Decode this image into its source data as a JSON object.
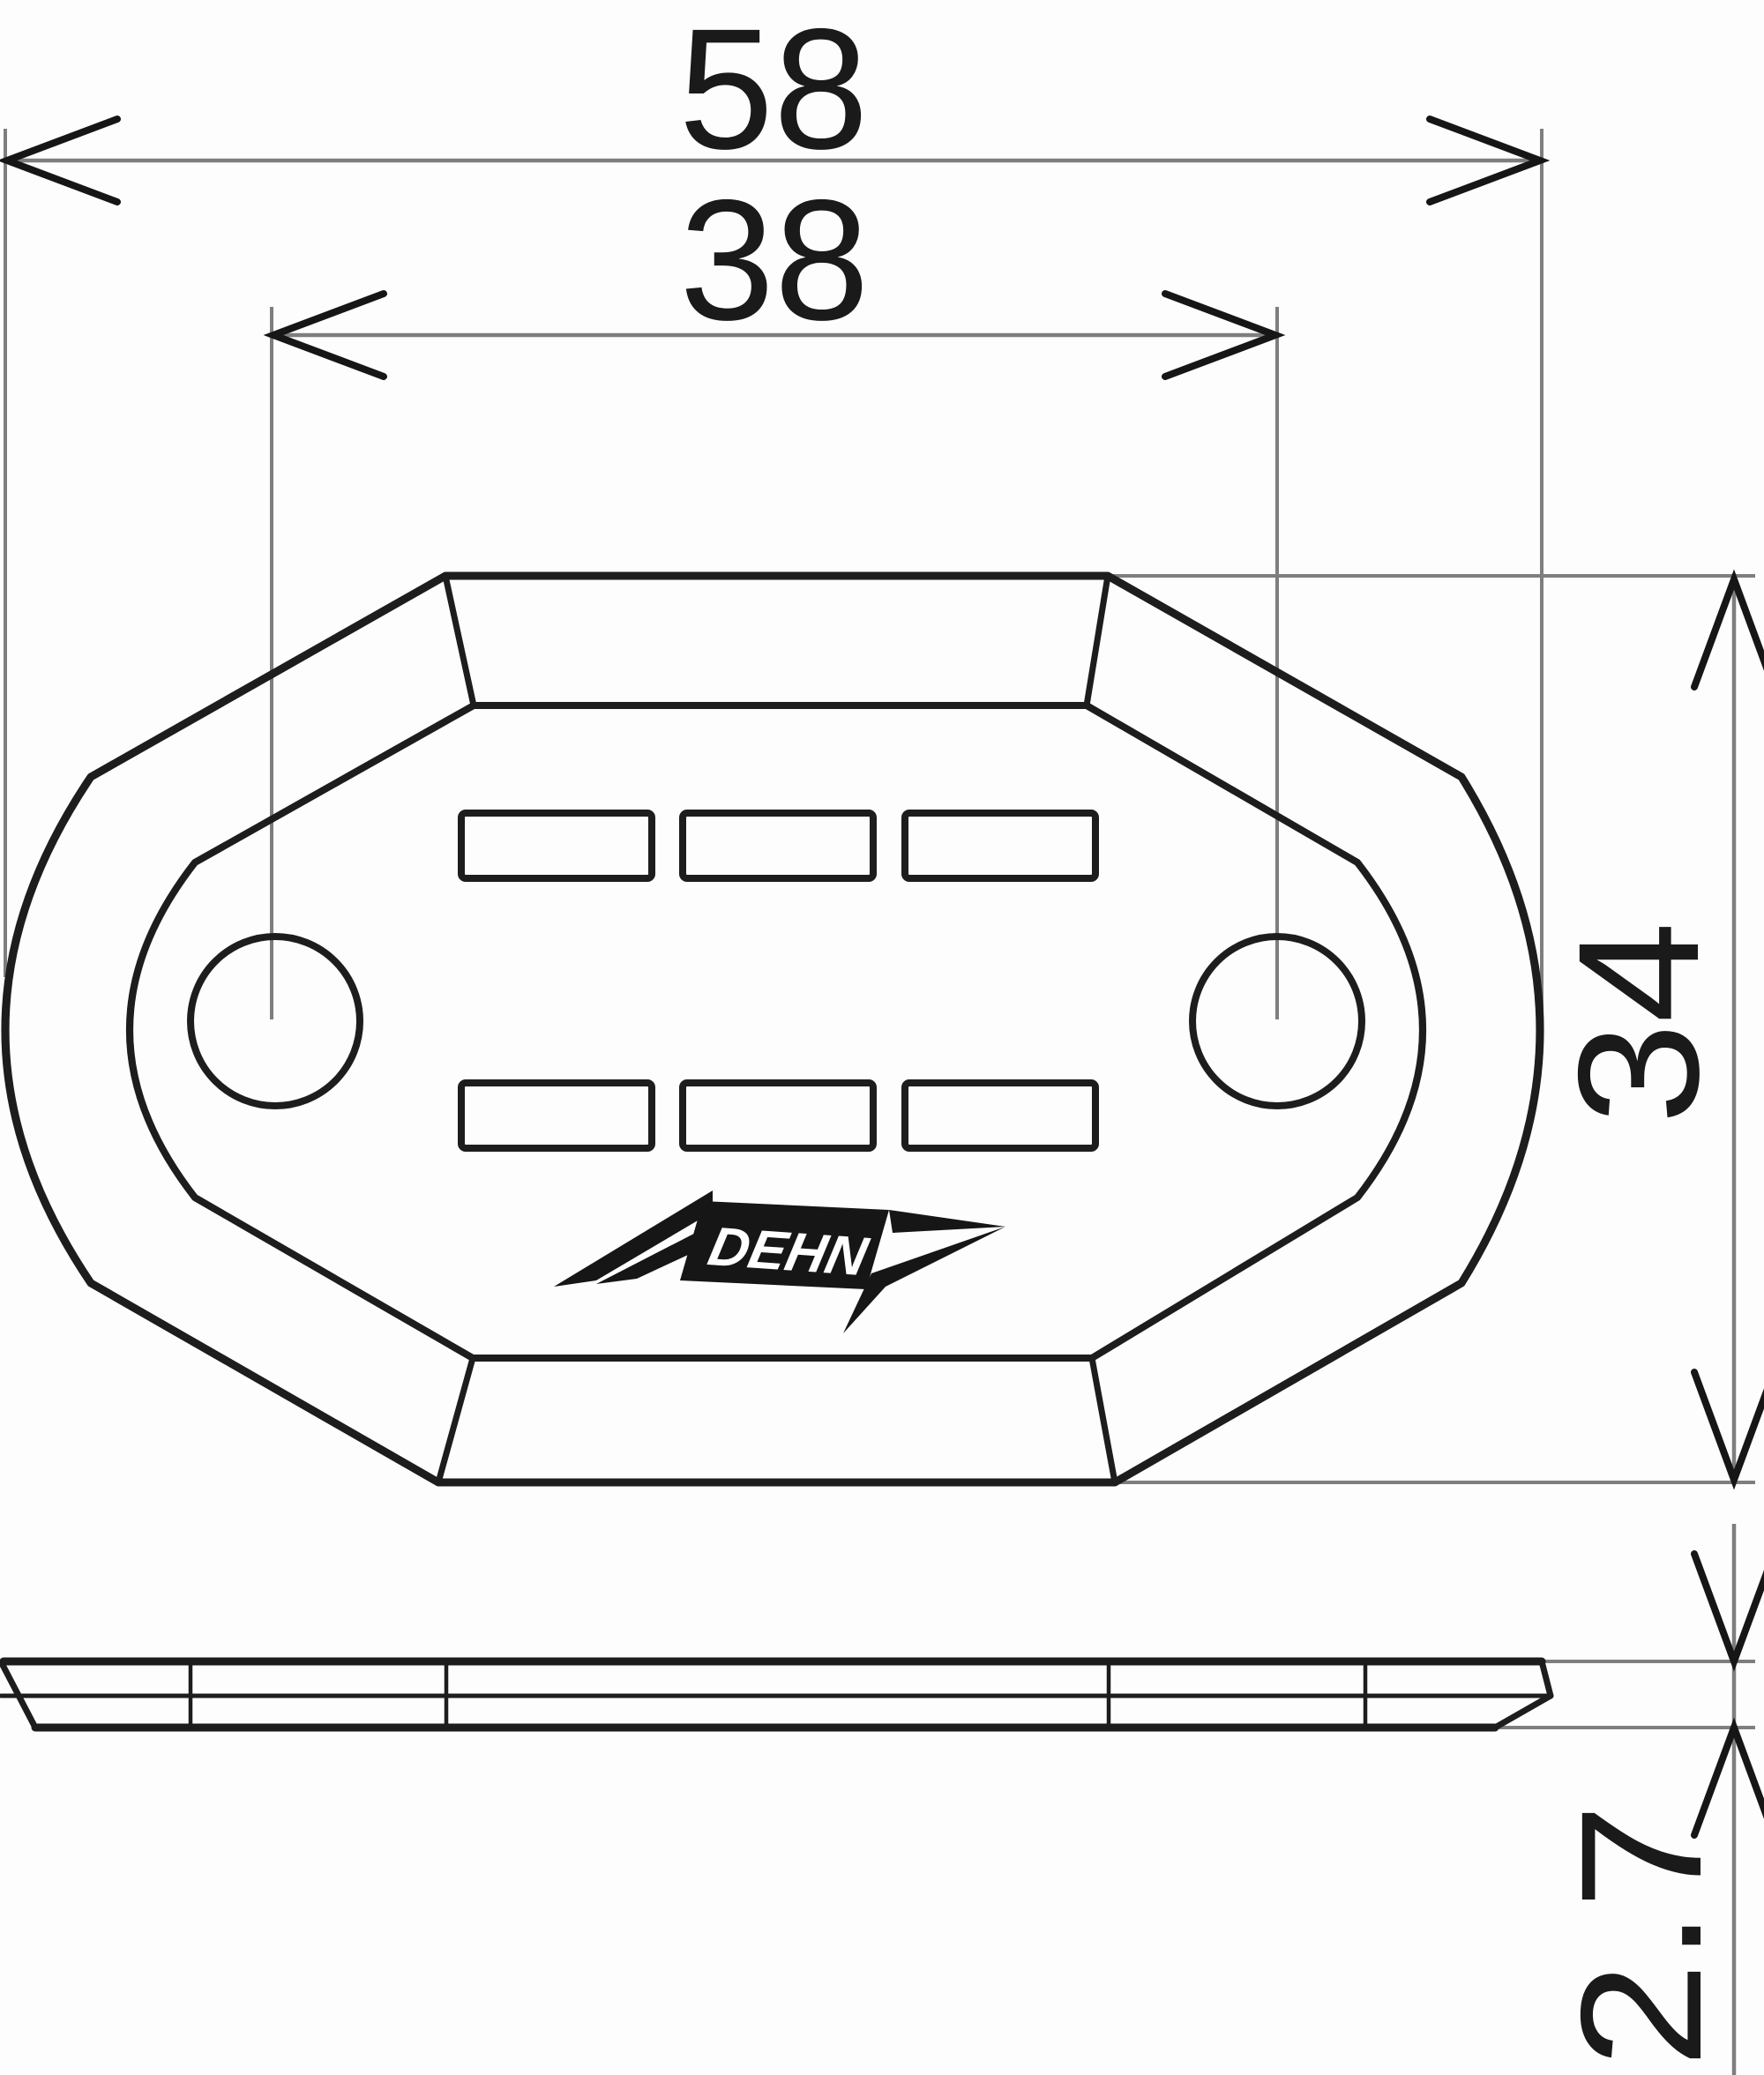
{
  "drawing": {
    "title": "Fixing plate dimension drawing",
    "type": "technical-dimension-drawing",
    "unit": "mm",
    "brand_logo": "DEHN",
    "dimensions": {
      "overall_width": {
        "value": "58",
        "orientation": "horizontal",
        "measures": "overall plate width"
      },
      "hole_spacing": {
        "value": "38",
        "orientation": "horizontal",
        "measures": "distance between mounting hole centers"
      },
      "overall_height": {
        "value": "34",
        "orientation": "vertical",
        "measures": "overall plate height"
      },
      "thickness": {
        "value": "2.7",
        "orientation": "vertical",
        "measures": "plate thickness (side view)"
      }
    },
    "features": {
      "mounting_holes": 2,
      "slots": 6,
      "slot_rows": 2,
      "views": [
        "top view",
        "side profile view"
      ]
    },
    "colors": {
      "outline": "#1d1d1d",
      "dimension_lines": "#7e7e7e",
      "arrows": "#161616",
      "background": "#fdfdfd"
    }
  }
}
